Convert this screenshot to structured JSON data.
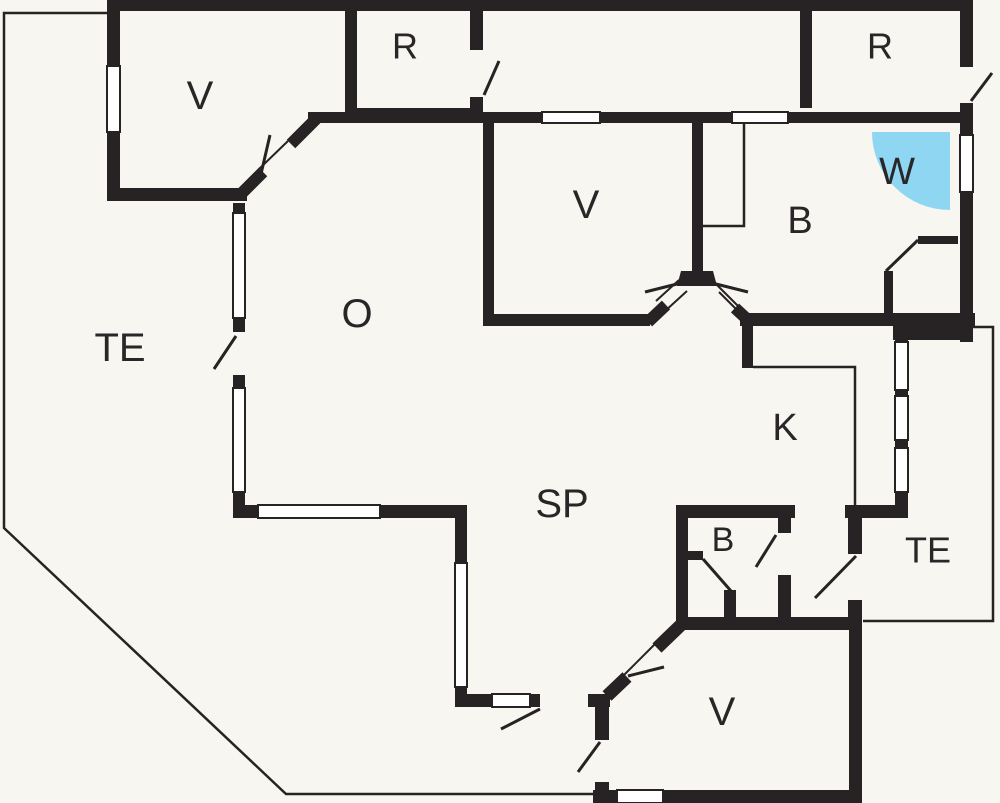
{
  "title": "Floor plan",
  "colors": {
    "background": "#f7f6f0",
    "wall": "#272223",
    "label": "#2a2627",
    "shower": "#8ed6f2",
    "window_fill": "#ffffff"
  },
  "legend": {
    "shower_symbol": "quarter-circle shower cabin",
    "window_symbol": "white gap with thin frame",
    "door_symbol": "wall gap with swing leaf line"
  },
  "rooms": [
    {
      "id": "bedroom-top-left",
      "label": "V"
    },
    {
      "id": "storage-top-left",
      "label": "R"
    },
    {
      "id": "storage-top-right",
      "label": "R"
    },
    {
      "id": "terrace-left",
      "label": "TE"
    },
    {
      "id": "main-room",
      "label": "O"
    },
    {
      "id": "bedroom-center",
      "label": "V"
    },
    {
      "id": "bathroom-right",
      "label": "B"
    },
    {
      "id": "shower-corner",
      "label": "W"
    },
    {
      "id": "kitchen",
      "label": "K"
    },
    {
      "id": "living-area",
      "label": "SP"
    },
    {
      "id": "bathroom-small",
      "label": "B"
    },
    {
      "id": "terrace-right",
      "label": "TE"
    },
    {
      "id": "bedroom-bottom",
      "label": "V"
    }
  ]
}
